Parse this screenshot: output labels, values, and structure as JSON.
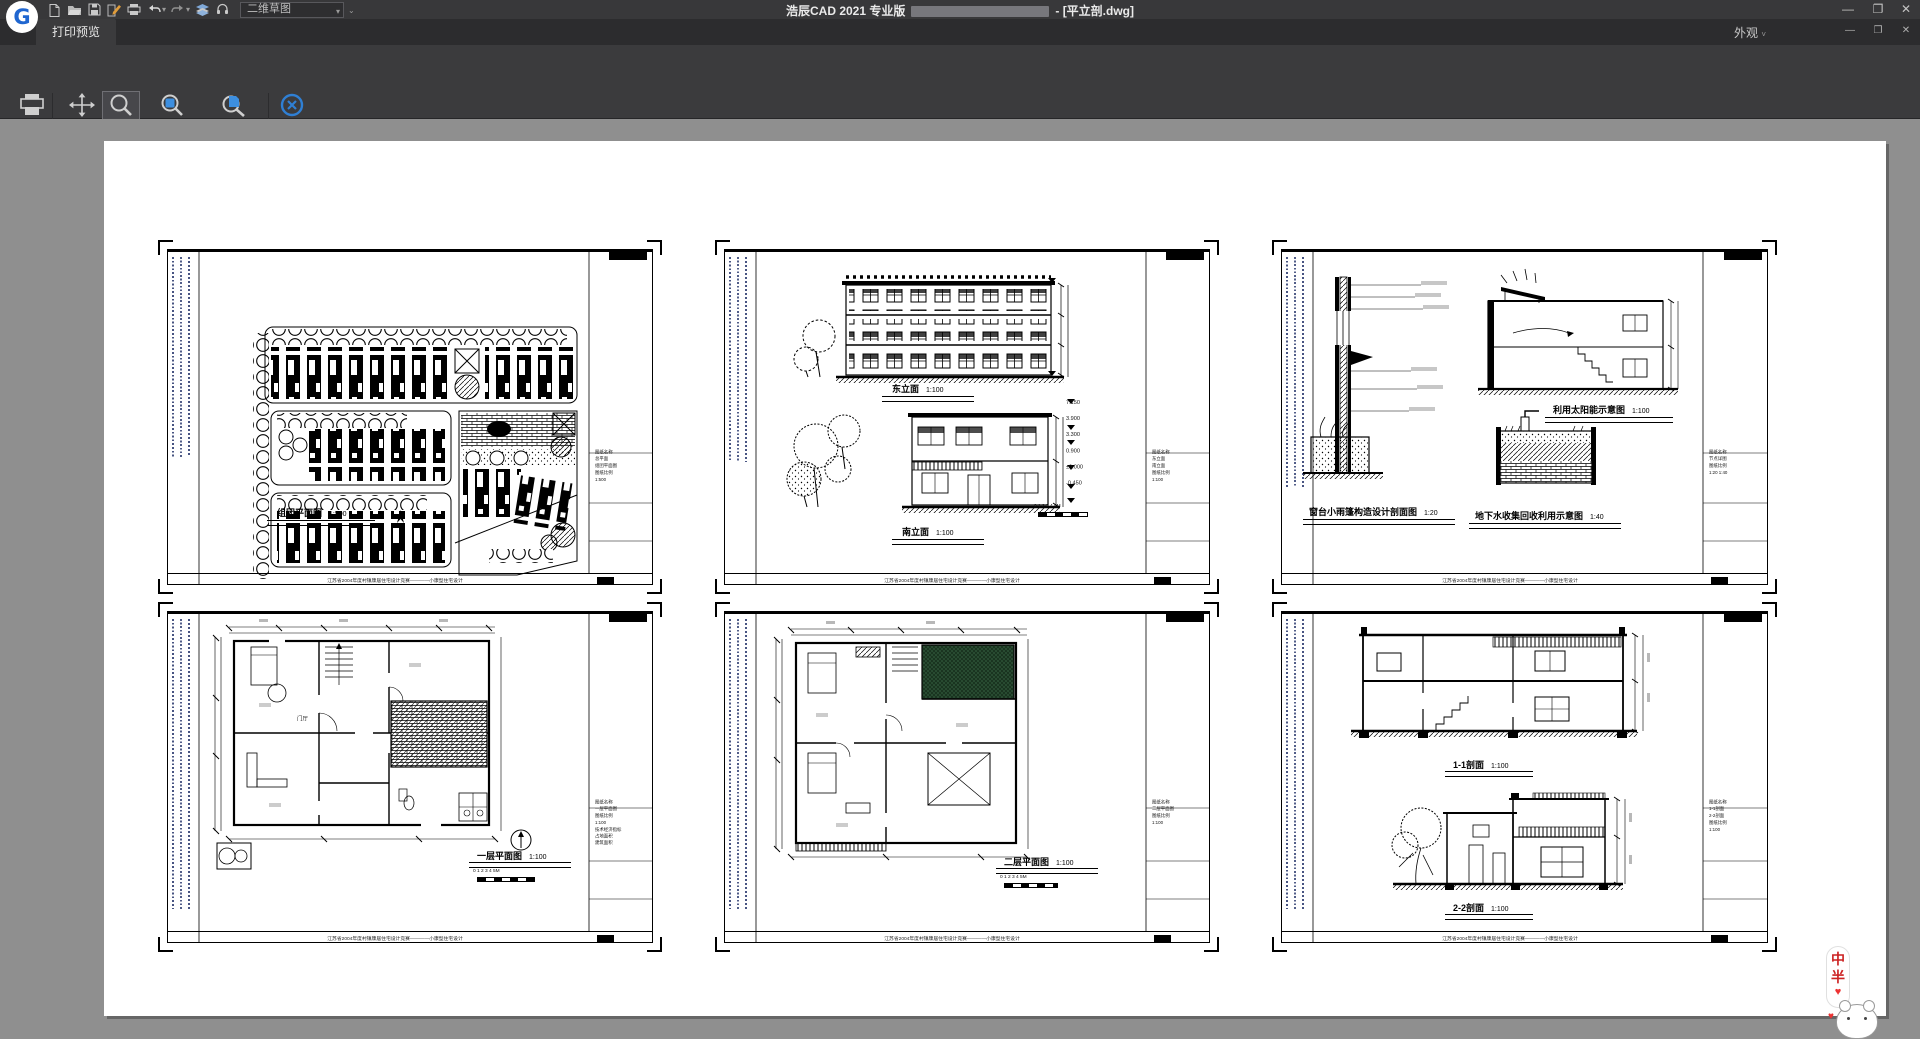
{
  "titlebar": {
    "app_title": "浩辰CAD 2021 专业版",
    "doc_suffix": "- [平立剖.dwg]",
    "workspace": "二维草图",
    "icons": [
      "new-file",
      "open-file",
      "save",
      "save-as",
      "plot",
      "undo",
      "redo",
      "layer-manager",
      "help-support"
    ]
  },
  "tabrow": {
    "preview_tab": "打印预览",
    "appearance": "外观"
  },
  "ribbon": {
    "print": {
      "label": "打印"
    },
    "pan": {
      "label": "平移"
    },
    "zoom": {
      "label": "缩放"
    },
    "window_zoom": {
      "label": "窗口缩放"
    },
    "fullscreen_zoom": {
      "label": "满屏缩放"
    },
    "close": {
      "label": "关闭"
    },
    "groups": {
      "print": "打印",
      "zoom": "缩放",
      "preview": "预览"
    },
    "active_tool": "缩放"
  },
  "sheet_footer": "江苏省2004年度村镇康居住宅设计竞赛————小康型住宅设计",
  "scalebar_label": "0 1 2 3 4 5M",
  "sheets": [
    {
      "name": "组团平面图",
      "captions": [
        {
          "t": "组团平面图",
          "s": "1:500"
        }
      ],
      "titleblock": "图纸名称\n总平面\n组团平面图\n图纸比例\n1:500"
    },
    {
      "name": "立面图",
      "captions": [
        {
          "t": "东立面",
          "s": "1:100"
        },
        {
          "t": "南立面",
          "s": "1:100"
        }
      ],
      "levels": "7.150\n3.900\n3.300\n0.900\n±0.000\n-0.450",
      "titleblock": "图纸名称\n东立面\n南立面\n图纸比例\n1:100"
    },
    {
      "name": "节点详图",
      "captions": [
        {
          "t": "利用太阳能示意图",
          "s": "1:100"
        },
        {
          "t": "窗台小雨篷构造设计剖面图",
          "s": "1:20"
        },
        {
          "t": "地下水收集回收利用示意图",
          "s": "1:40"
        }
      ],
      "titleblock": "图纸名称\n节点详图\n图纸比例\n1:20 1:40"
    },
    {
      "name": "一层平面图",
      "captions": [
        {
          "t": "一层平面图",
          "s": "1:100"
        }
      ],
      "room_label": "门厅",
      "titleblock": "图纸名称\n一层平面图\n图纸比例\n1:100\n技术经济指标\n占地面积\n建筑面积"
    },
    {
      "name": "二层平面图",
      "captions": [
        {
          "t": "二层平面图",
          "s": "1:100"
        }
      ],
      "titleblock": "图纸名称\n二层平面图\n图纸比例\n1:100"
    },
    {
      "name": "剖面图",
      "captions": [
        {
          "t": "1-1剖面",
          "s": "1:100"
        },
        {
          "t": "2-2剖面",
          "s": "1:100"
        }
      ],
      "titleblock": "图纸名称\n1-1剖面\n2-2剖面\n图纸比例\n1:100"
    }
  ],
  "mascot": {
    "char_top": "中",
    "char_bottom": "半",
    "heart": "♥"
  }
}
